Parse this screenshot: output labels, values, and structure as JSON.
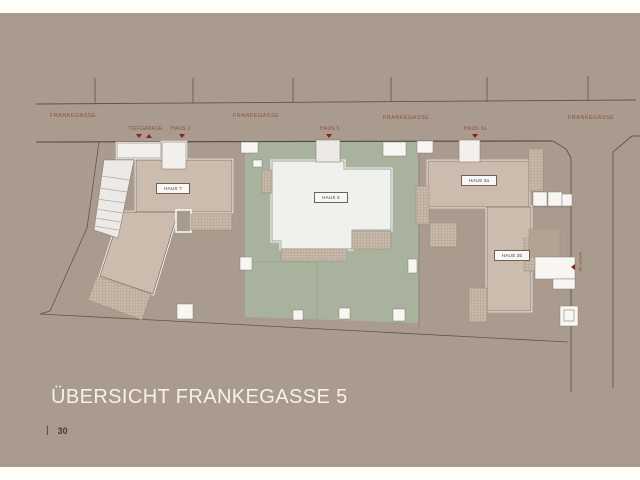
{
  "page": {
    "title": "ÜBERSICHT FRANKEGASSE 5",
    "page_number": "30",
    "page_number_separator": "|"
  },
  "colors": {
    "paper_white": "#fffdf8",
    "background_taupe": "#a99b8d",
    "garden_green": "#a8b29c",
    "building_tan": "#cbbcae",
    "building_light": "#eff1ed",
    "terrace_hatch": "#c8baab",
    "boundary_line": "#5e564c",
    "marker_red": "#8e1f1c",
    "street_label_red": "#8f5047"
  },
  "plan": {
    "street_labels": [
      {
        "text": "FRANKEGASSE"
      },
      {
        "text": "FRANKEGASSE"
      },
      {
        "text": "FRANKEGASSE"
      },
      {
        "text": "FRANKEGASSE"
      }
    ],
    "entrance_labels": [
      {
        "text": "TIEFGARAGE"
      },
      {
        "text": "HAUS 1"
      },
      {
        "text": "HAUS 5"
      },
      {
        "text": "HAUS 3a"
      }
    ],
    "house_labels": [
      {
        "text": "HAUS 7"
      },
      {
        "text": "HAUS 5"
      },
      {
        "text": "HAUS 3a"
      },
      {
        "text": "HAUS 3b"
      }
    ],
    "side_label": {
      "text": "HAUS 3b"
    }
  }
}
